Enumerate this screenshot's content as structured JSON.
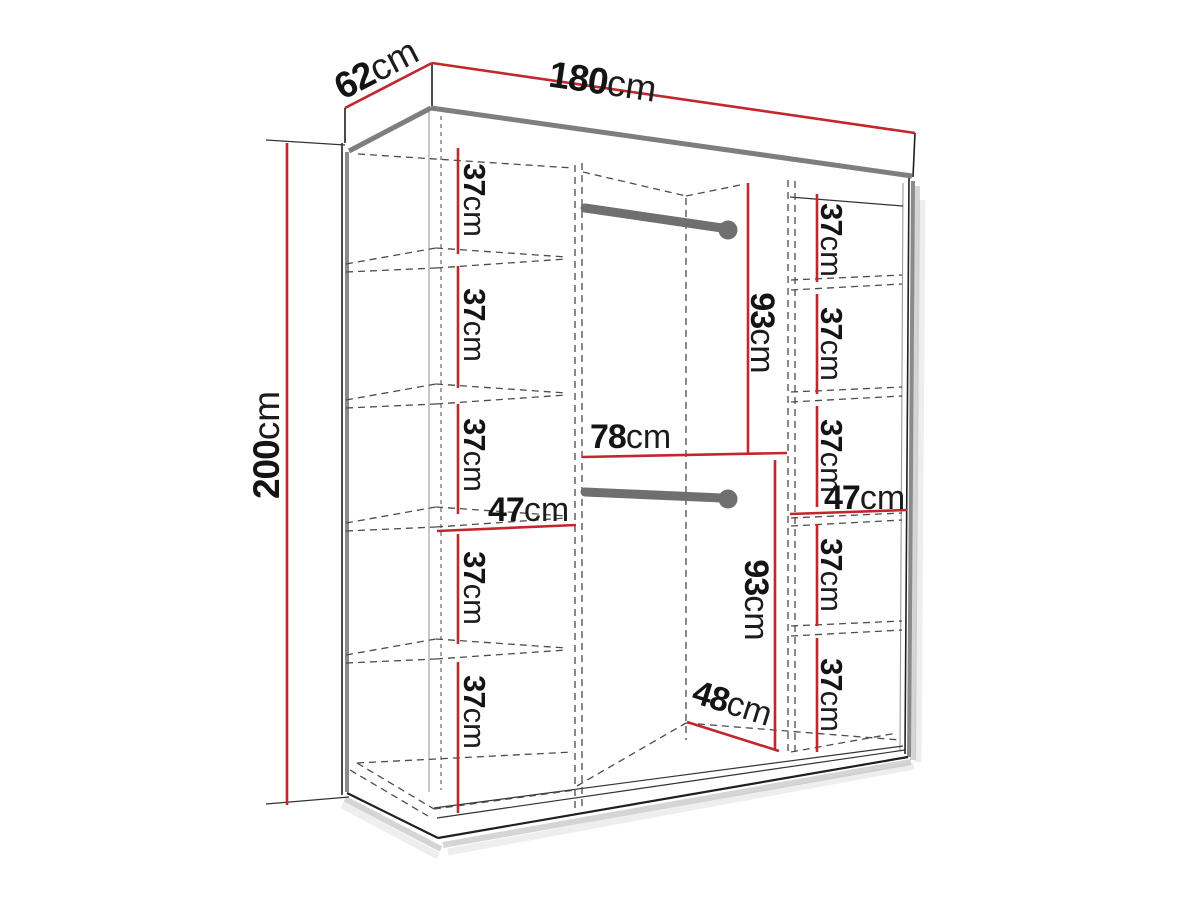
{
  "page_background": "#ffffff",
  "diagram": {
    "type": "wardrobe-dimension-diagram",
    "accent_color": "#c1272d",
    "line_color": "#1f1f1f",
    "unit": "cm",
    "overall": {
      "width": {
        "num": "180",
        "unit": "cm"
      },
      "depth": {
        "num": "62",
        "unit": "cm"
      },
      "height": {
        "num": "200",
        "unit": "cm"
      }
    },
    "left_column_sections": [
      {
        "num": "37",
        "unit": "cm"
      },
      {
        "num": "37",
        "unit": "cm"
      },
      {
        "num": "37",
        "unit": "cm"
      },
      {
        "num": "37",
        "unit": "cm"
      },
      {
        "num": "37",
        "unit": "cm"
      }
    ],
    "right_column_sections": [
      {
        "num": "37",
        "unit": "cm"
      },
      {
        "num": "37",
        "unit": "cm"
      },
      {
        "num": "37",
        "unit": "cm"
      },
      {
        "num": "37",
        "unit": "cm"
      },
      {
        "num": "37",
        "unit": "cm"
      }
    ],
    "middle_section": {
      "upper_hanging_height": {
        "num": "93",
        "unit": "cm"
      },
      "lower_hanging_height": {
        "num": "93",
        "unit": "cm"
      },
      "width": {
        "num": "78",
        "unit": "cm"
      },
      "depth": {
        "num": "48",
        "unit": "cm"
      }
    },
    "left_shelf_width": {
      "num": "47",
      "unit": "cm"
    },
    "right_shelf_width": {
      "num": "47",
      "unit": "cm"
    }
  }
}
